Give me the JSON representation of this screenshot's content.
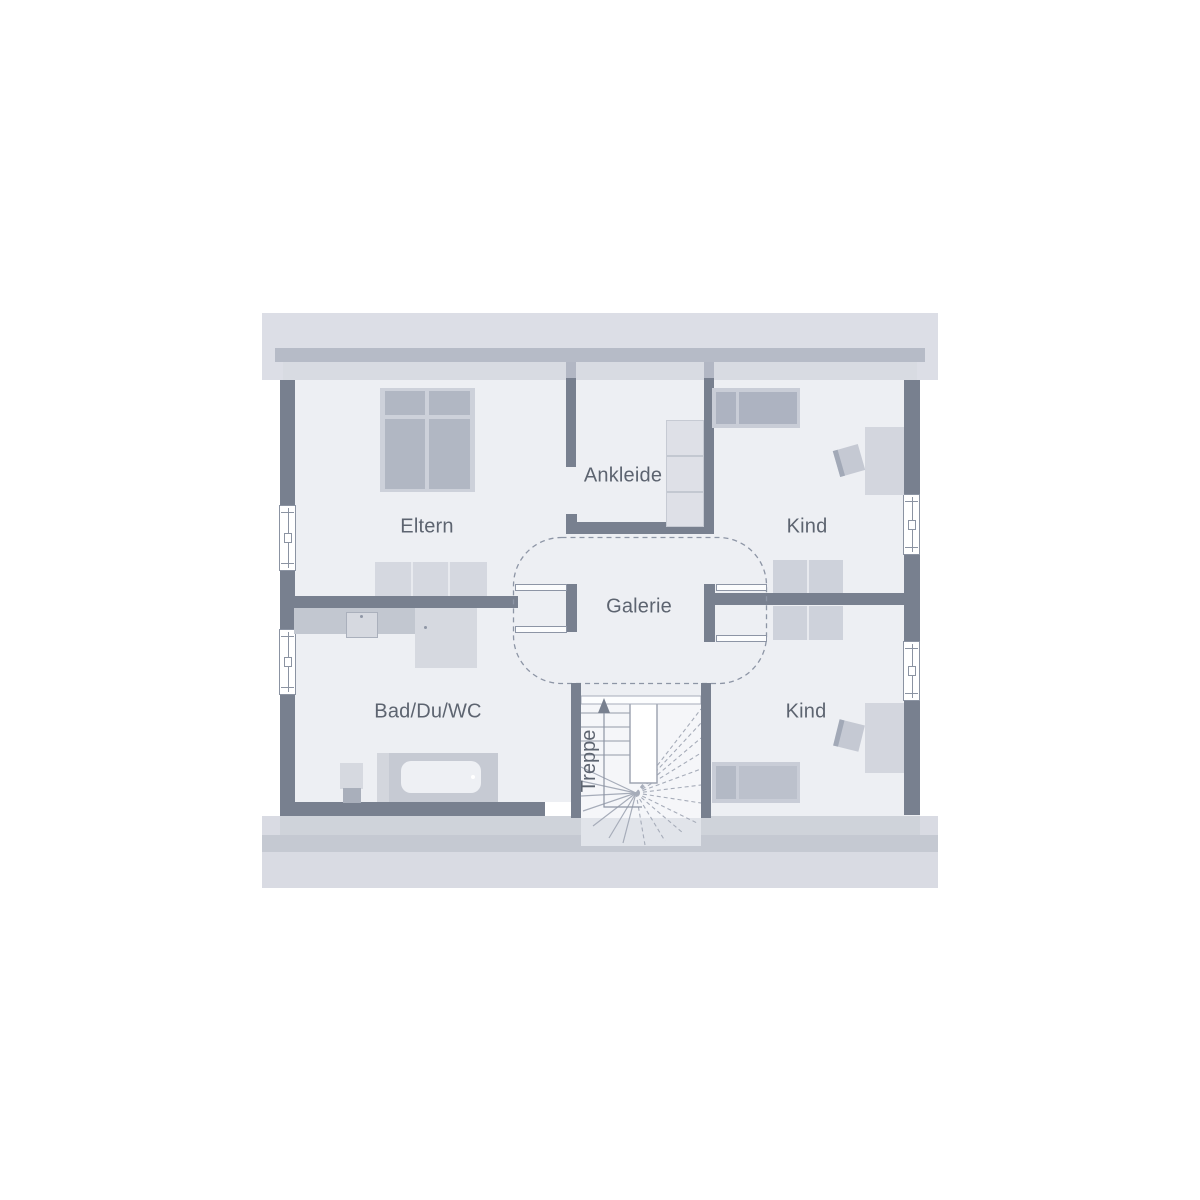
{
  "rooms": {
    "eltern": "Eltern",
    "ankleide": "Ankleide",
    "kind_top": "Kind",
    "kind_bottom": "Kind",
    "bad": "Bad/Du/WC",
    "galerie": "Galerie",
    "treppe": "Treppe"
  },
  "colors": {
    "wall_dark": "#78808f",
    "knee_wall": "#b6bbc7",
    "roof_band": "#dcdee6",
    "attic_strip": "#d8dbe2",
    "floor": "#edeff3",
    "band_mid": "#cfd3da",
    "band_dark": "#c5c9d2",
    "furniture_dark": "#b1b7c3",
    "furniture_mid": "#c9cdd7",
    "furniture_light": "#d5d8e0",
    "stair_line": "#a6acb9",
    "label_text": "#5d6470"
  }
}
